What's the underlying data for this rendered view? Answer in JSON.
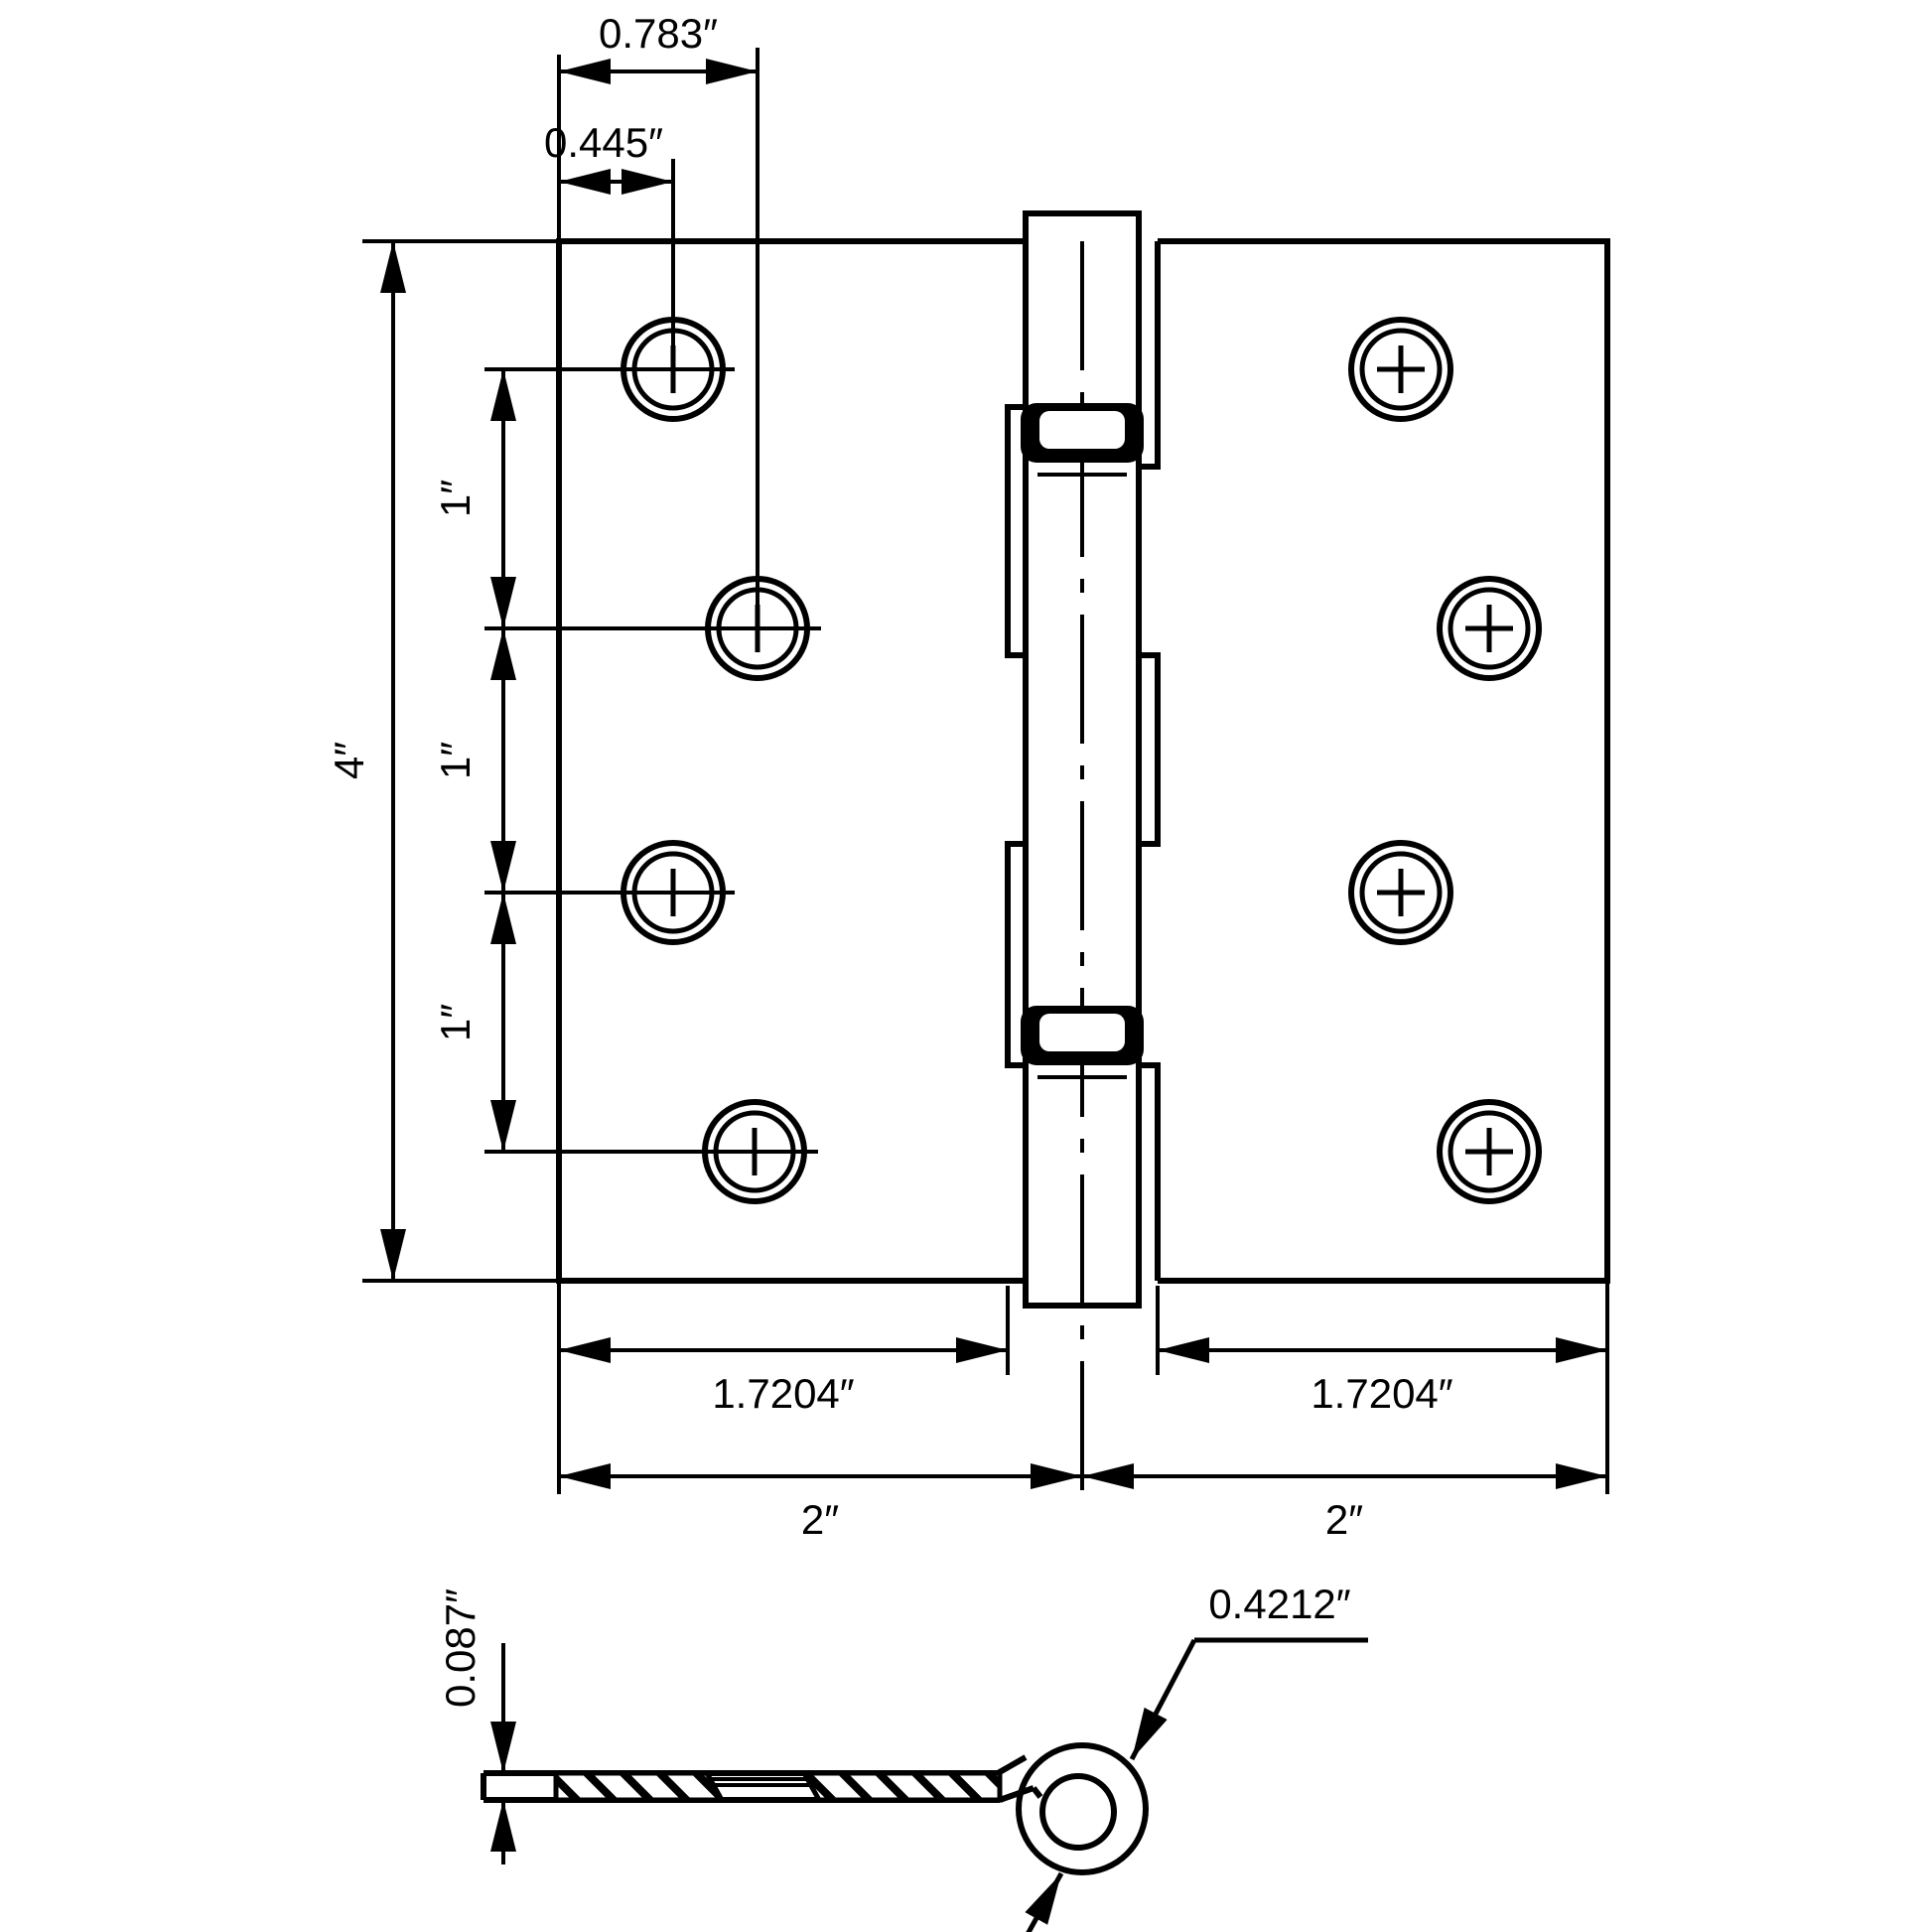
{
  "drawing": {
    "title": "butt-hinge-dimension-drawing",
    "colors": {
      "line": "#000000",
      "background": "#ffffff"
    },
    "front_view": {
      "dim_top_outer": "0.783″",
      "dim_top_inner": "0.445″",
      "dim_height": "4″",
      "dim_hole_spacing": [
        "1″",
        "1″",
        "1″"
      ],
      "dim_leaf_left": "1.7204″",
      "dim_leaf_right": "1.7204″",
      "dim_half_left": "2″",
      "dim_half_right": "2″"
    },
    "side_view": {
      "dim_thickness": "0.087″",
      "dim_knuckle": "0.4212″"
    }
  }
}
